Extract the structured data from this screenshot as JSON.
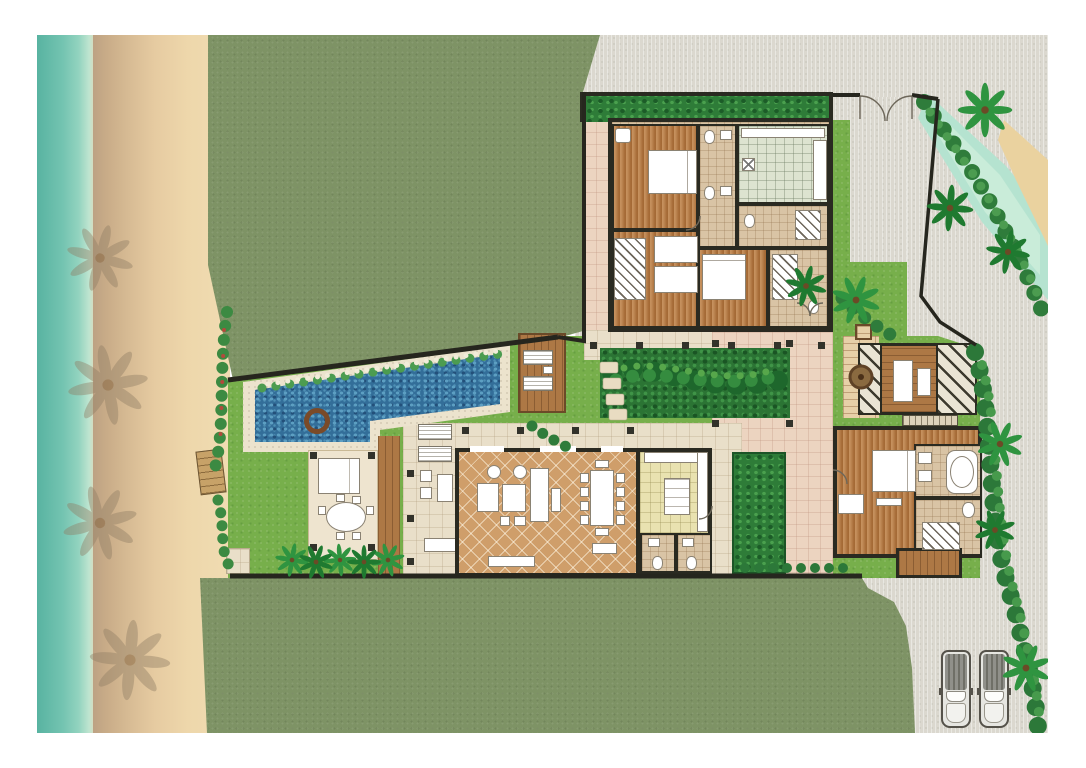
{
  "title": "Tropical beachfront villa — illustrated top-down site and floor plan",
  "plan_type": "architectural site plan rendering (no text labels in drawing)",
  "palette": {
    "paper_margin": "#ffffff",
    "sea": "#74c4b1",
    "beach_sand": "#eed7ab",
    "outer_lawn": "#7e9365",
    "garden_grass": "#77af4b",
    "hedge_green": "#2e7c38",
    "pool_water": "#336e99",
    "pool_coping": "#ece3cd",
    "timber_deck": "#ad7845",
    "bedroom_wood_floor": "#b5783f",
    "living_tile": "#cf9e6a",
    "bathroom_tile": "#d9c4a5",
    "service_tile": "#dde3d0",
    "kitchen_floor": "#e9e2b0",
    "terrace_paving": "#e9dfc9",
    "courtyard_paving": "#ecd4c0",
    "road": "#dbd8cf",
    "canal_water": "#b5e3d0",
    "canal_bank_sand": "#ead29f",
    "walls": "#2a2a21",
    "furniture_fixture": "#ffffff",
    "brick_court": "#e7d0a8"
  },
  "site": {
    "west": [
      "sea",
      "beach with palm-tree shadows",
      "wooden bench",
      "stone pad"
    ],
    "north_and_south": [
      "large olive-green lawns enclosed by boundary wall"
    ],
    "east": [
      "access road",
      "water canal with sandy bank and palms",
      "roadside foliage",
      "parking bay"
    ],
    "vehicles_parked": 2,
    "entry": [
      "double entry gate on north wall",
      "gravel driveway",
      "brick court with circular medallion",
      "square planter"
    ]
  },
  "landscape": {
    "pool": "long lap pool with angled north edge, stepped south edge and round spa",
    "sun_decks": [
      "timber deck with 2 loungers beside pool",
      "2 loungers on main terrace"
    ],
    "sala": "open-air pavilion with daybed and round dining table with 6 chairs",
    "boardwalk": "timber walkway from sala to south terrace",
    "planting": [
      "privacy hedge inside guest-wing wall",
      "central tropical planter bed",
      "courtyard hedge strip",
      "palm row at sala",
      "shrub-and-flower border along beach edge"
    ]
  },
  "buildings": {
    "guest_wing": {
      "location": "north-east block",
      "rooms": [
        "bedroom with queen bed and armchair",
        "bedroom with two single beds and wardrobes",
        "bedroom with queen bed",
        "bathroom core with WCs and basins",
        "service / laundry room with counters and washer",
        "dressing room with closet"
      ],
      "features": [
        "hedge screen along street wall",
        "south colonnade terrace"
      ]
    },
    "living_pavilion": {
      "location": "center-south block",
      "rooms": [
        "living room",
        "dining room",
        "kitchen",
        "two powder rooms"
      ],
      "furniture": [
        "two round armchairs",
        "chaise",
        "square coffee table",
        "long sofa",
        "two ottomans",
        "TV sideboard",
        "console",
        "dining table with 10 chairs",
        "kitchen island with cooktop",
        "L-shaped counters"
      ]
    },
    "master_suite": {
      "location": "east block",
      "rooms": [
        "master bedroom with king bed, desk and foot bench",
        "bathroom with bathtub and twin basins",
        "dressing room with closet and WC"
      ],
      "features": [
        "private pergola-covered spa deck with massage tables",
        "timber rear walkway"
      ]
    }
  }
}
